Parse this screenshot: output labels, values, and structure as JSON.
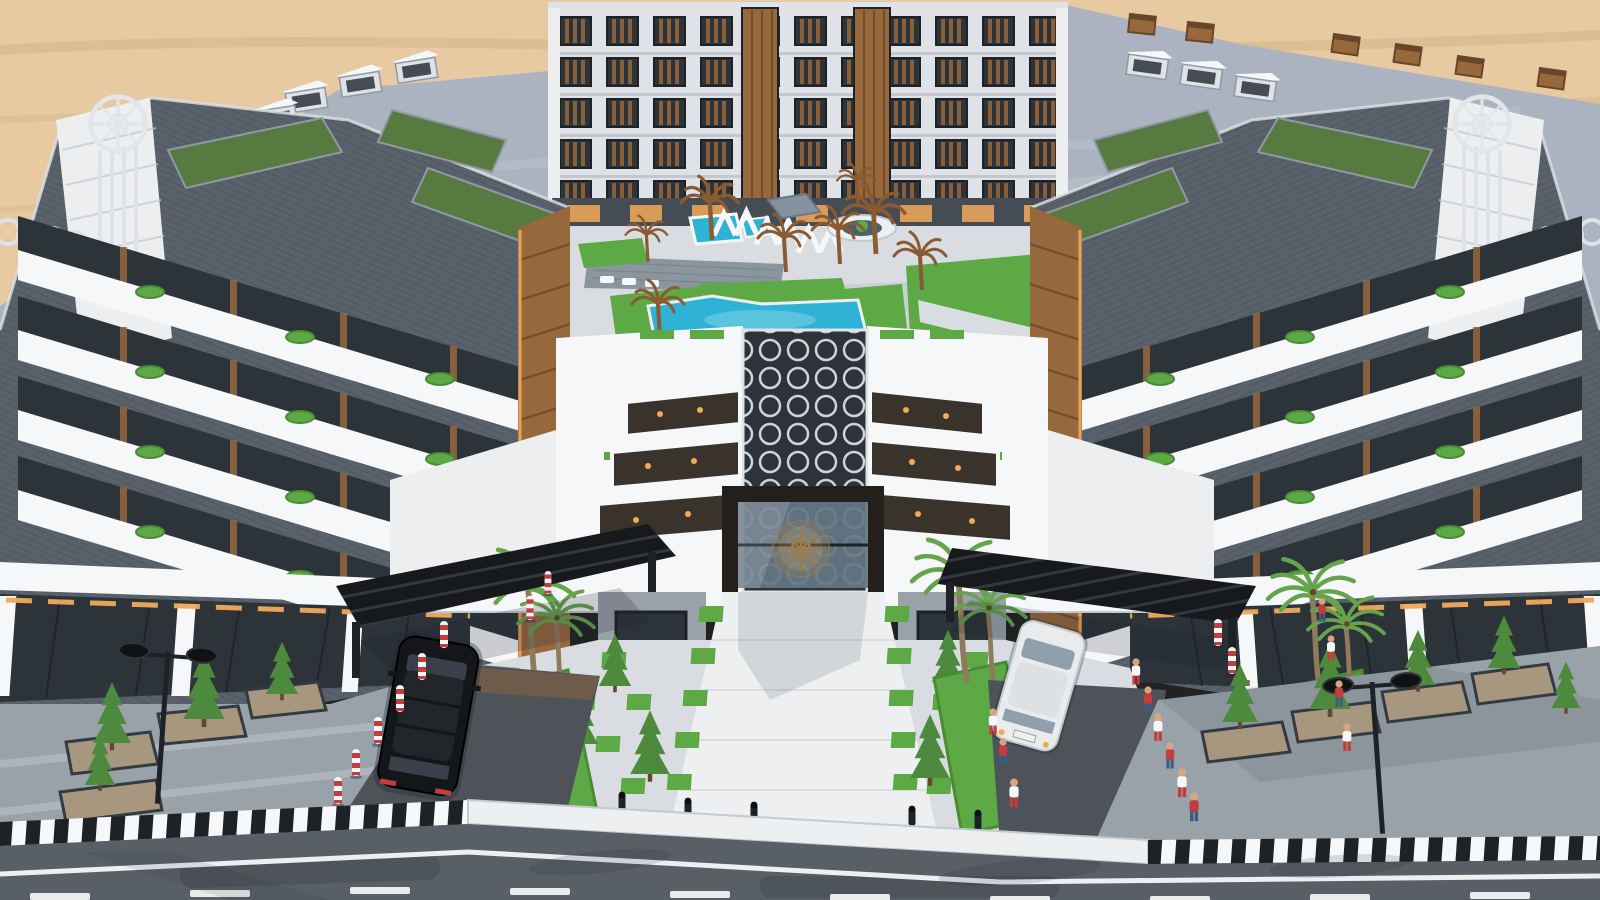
{
  "scene": {
    "type": "architectural-render",
    "description": "Aerial 3D rendering of a modern U-shaped residential apartment compound in a desert setting: grey-and-white apartment wings with rooftop gardens and planted balconies surround a landscaped courtyard with turquoise swimming pools; a gated main entrance with a bronze circular emblem and honeycomb glass walkway leads to a checkerboard-lawn plaza flanked by palm trees, entry driveways with black slatted canopies, a black SUV entering and a white car exiting, pedestrians along the walls, and a front street with striped curbs, lane markings, planters and twin street lamps.",
    "environment": {
      "backdrop": "desert sand",
      "time_of_day": "day"
    },
    "objects": [
      "left-wing-building",
      "right-wing-building",
      "rear-building",
      "rooftop-gardens",
      "roof-bulkheads",
      "roof-chimneys",
      "tower-compass-emblems",
      "ring-ornaments",
      "courtyard",
      "swimming-pools",
      "wood-deck",
      "pergolas",
      "umbrella",
      "sculptural-brown-palms",
      "round-planter",
      "entrance-gate",
      "gate-emblem",
      "honeycomb-glass-walkway",
      "skylight-steps",
      "entrance-plaza",
      "checker-lawn-pavers",
      "conifer-trees",
      "palm-trees",
      "black-suv",
      "white-car",
      "entry-canopies",
      "red-white-bollards",
      "black-bollards",
      "pedestrians",
      "sidewalk-planters",
      "street-lamps",
      "striped-curb",
      "road",
      "road-markings"
    ],
    "counts": {
      "pedestrians": 13,
      "cars": 2,
      "pools": 3,
      "street_lamps": 2,
      "entry_canopies": 2
    }
  },
  "palette": {
    "sand": "#e7c9a2",
    "sandDk": "#d5b183",
    "rock": "#b08f68",
    "roof": "#aab3bf",
    "roofLt": "#c2cad4",
    "roofSh": "#8f99a6",
    "white": "#f6f7f8",
    "cWhite": "#eceef0",
    "offW": "#dfe3e7",
    "clad": "#59616a",
    "cladDk": "#454c54",
    "rib": "#3c434b",
    "wood": "#96683c",
    "woodDk": "#67462a",
    "glass": "#2c3339",
    "glassBlue": "#657786",
    "frame": "#1d2227",
    "gRoof": "#567a40",
    "lawn": "#5da945",
    "lawnDk": "#498c34",
    "pool": "#2eb2d6",
    "poolLt": "#7fd4e8",
    "pave": "#d9dde1",
    "paveMid": "#c2c9cf",
    "walk": "#edeff0",
    "deck": "#8b959e",
    "asph": "#595f66",
    "asphDk": "#43494f",
    "drive": "#4d5359",
    "swalk": "#99a1a9",
    "cnpy": "#17191d",
    "carB": "#14161a",
    "carW": "#e9ebec",
    "red": "#c43d3d",
    "bronze": "#9c7d4e",
    "warm": "#f2a95a",
    "tree": "#4d8a3d",
    "palm": "#65a44c",
    "trunk": "#8d7b5c",
    "bPalm": "#8a5a33",
    "silver": "#e2e6ea",
    "skin": "#d9a57e",
    "shadow": "#1c2430"
  }
}
